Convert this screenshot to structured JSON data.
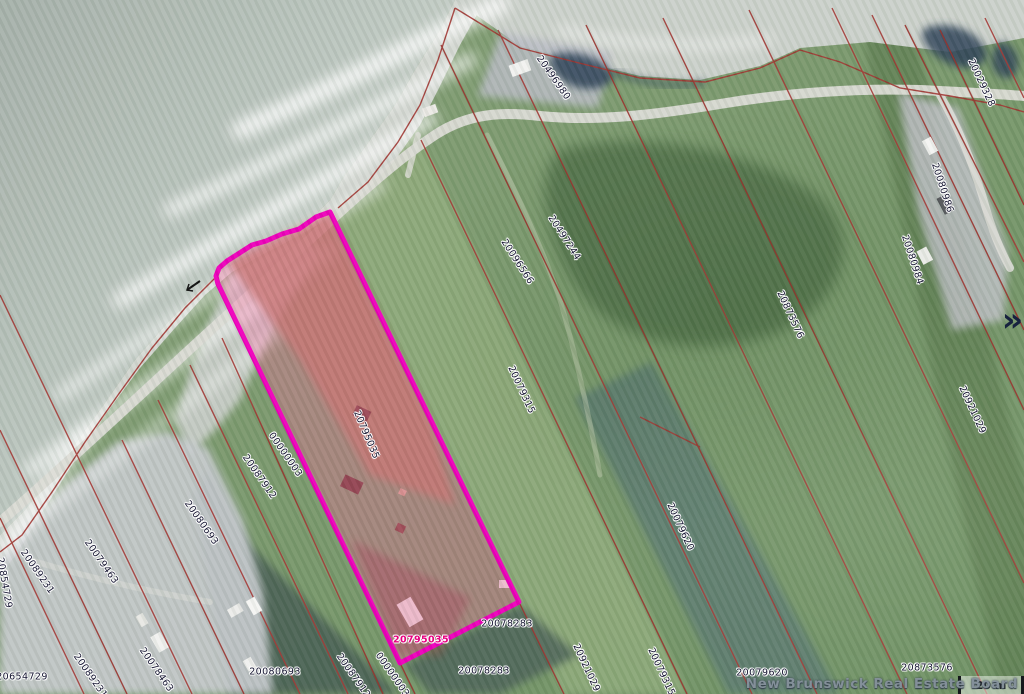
{
  "map": {
    "watermark": "New Brunswick Real Estate Board",
    "scale_bar": {
      "label": "20 m"
    },
    "expand_icon": "»",
    "highlighted_parcel_id": "20795035",
    "colors": {
      "highlight_outline": "#ee00bb",
      "highlight_fill": "#ff5f9e",
      "parcel_line": "#a03430",
      "water": "#aeb8b1",
      "label_text": "#141430",
      "highlight_label_text": "#e6007e"
    },
    "labels": [
      {
        "t": "20496980",
        "x": 553,
        "y": 78,
        "r": 55
      },
      {
        "t": "20029328",
        "x": 981,
        "y": 83,
        "r": 65
      },
      {
        "t": "20080986",
        "x": 942,
        "y": 188,
        "r": 72
      },
      {
        "t": "20497244",
        "x": 564,
        "y": 238,
        "r": 57
      },
      {
        "t": "20096566",
        "x": 517,
        "y": 262,
        "r": 57
      },
      {
        "t": "20080984",
        "x": 912,
        "y": 260,
        "r": 72
      },
      {
        "t": "20873576",
        "x": 790,
        "y": 315,
        "r": 65
      },
      {
        "t": "20921029",
        "x": 972,
        "y": 410,
        "r": 65
      },
      {
        "t": "20079315",
        "x": 521,
        "y": 390,
        "r": 65
      },
      {
        "t": "20795035",
        "x": 366,
        "y": 435,
        "r": 67
      },
      {
        "t": "00000003",
        "x": 285,
        "y": 455,
        "r": 55
      },
      {
        "t": "20087912",
        "x": 259,
        "y": 477,
        "r": 55
      },
      {
        "t": "20080693",
        "x": 201,
        "y": 523,
        "r": 55
      },
      {
        "t": "20079620",
        "x": 680,
        "y": 527,
        "r": 65
      },
      {
        "t": "20079463",
        "x": 101,
        "y": 562,
        "r": 55
      },
      {
        "t": "20089231",
        "x": 37,
        "y": 572,
        "r": 55
      },
      {
        "t": "20854729",
        "x": 4,
        "y": 583,
        "r": 80
      },
      {
        "t": "20654729",
        "x": 22,
        "y": 677,
        "r": 0
      },
      {
        "t": "20089231",
        "x": 90,
        "y": 676,
        "r": 55
      },
      {
        "t": "20078463",
        "x": 156,
        "y": 670,
        "r": 55
      },
      {
        "t": "20080693",
        "x": 275,
        "y": 672,
        "r": 0
      },
      {
        "t": "20087912",
        "x": 353,
        "y": 676,
        "r": 55
      },
      {
        "t": "00000003",
        "x": 392,
        "y": 675,
        "r": 55
      },
      {
        "t": "20795035",
        "x": 421,
        "y": 640,
        "r": 0,
        "v": "highlight"
      },
      {
        "t": "20078283",
        "x": 507,
        "y": 624,
        "r": 0
      },
      {
        "t": "20078283",
        "x": 484,
        "y": 671,
        "r": 0
      },
      {
        "t": "20921029",
        "x": 586,
        "y": 668,
        "r": 65
      },
      {
        "t": "20079315",
        "x": 661,
        "y": 672,
        "r": 65
      },
      {
        "t": "20079620",
        "x": 762,
        "y": 673,
        "r": 0
      },
      {
        "t": "20873576",
        "x": 927,
        "y": 668,
        "r": 0
      }
    ]
  }
}
